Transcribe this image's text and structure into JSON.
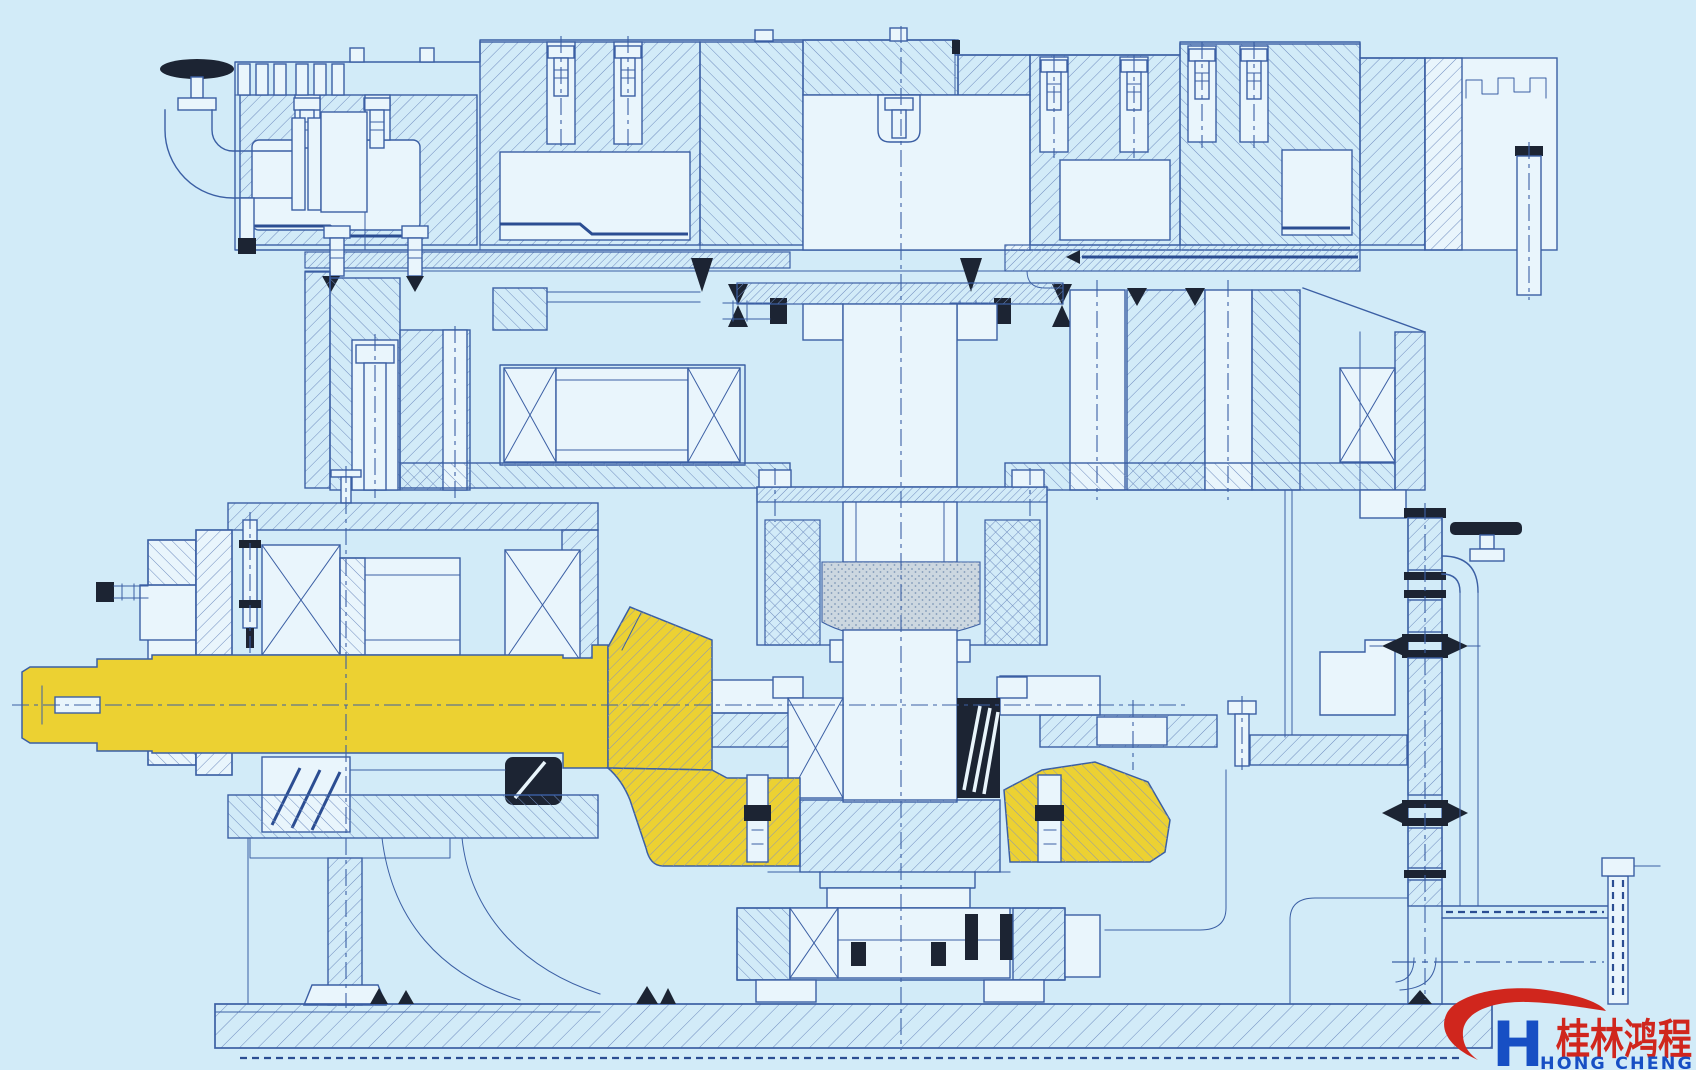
{
  "page": {
    "type": "technical-drawing",
    "description": "Cross-section engineering drawing (blueprint style) of a vertical grinding mill gear drive; the horizontal input shaft with bevel pinion and the mating bevel ring gear are highlighted in yellow",
    "width_px": 1696,
    "height_px": 1070
  },
  "colors": {
    "bg": "#d2ebf8",
    "line": "#3b5fa4",
    "hatch": "#6f8cbf",
    "dark": "#1c2433",
    "paper": "#e9f5fc",
    "yellow": "#ecd132",
    "yhatch": "#8d97b4",
    "red": "#d0261d",
    "blue": "#174fc4"
  },
  "drawing": {
    "style": "section view with hatched cut surfaces and dash-dot centerlines",
    "highlight_color": "#ecd132",
    "highlighted_parts": [
      "input shaft",
      "bevel pinion",
      "bevel ring gear"
    ]
  },
  "logo": {
    "monogram": "H",
    "chinese_name": "桂林鸿程",
    "english_name": "HONG CHENG",
    "red": "#d0261d",
    "blue": "#174fc4"
  }
}
